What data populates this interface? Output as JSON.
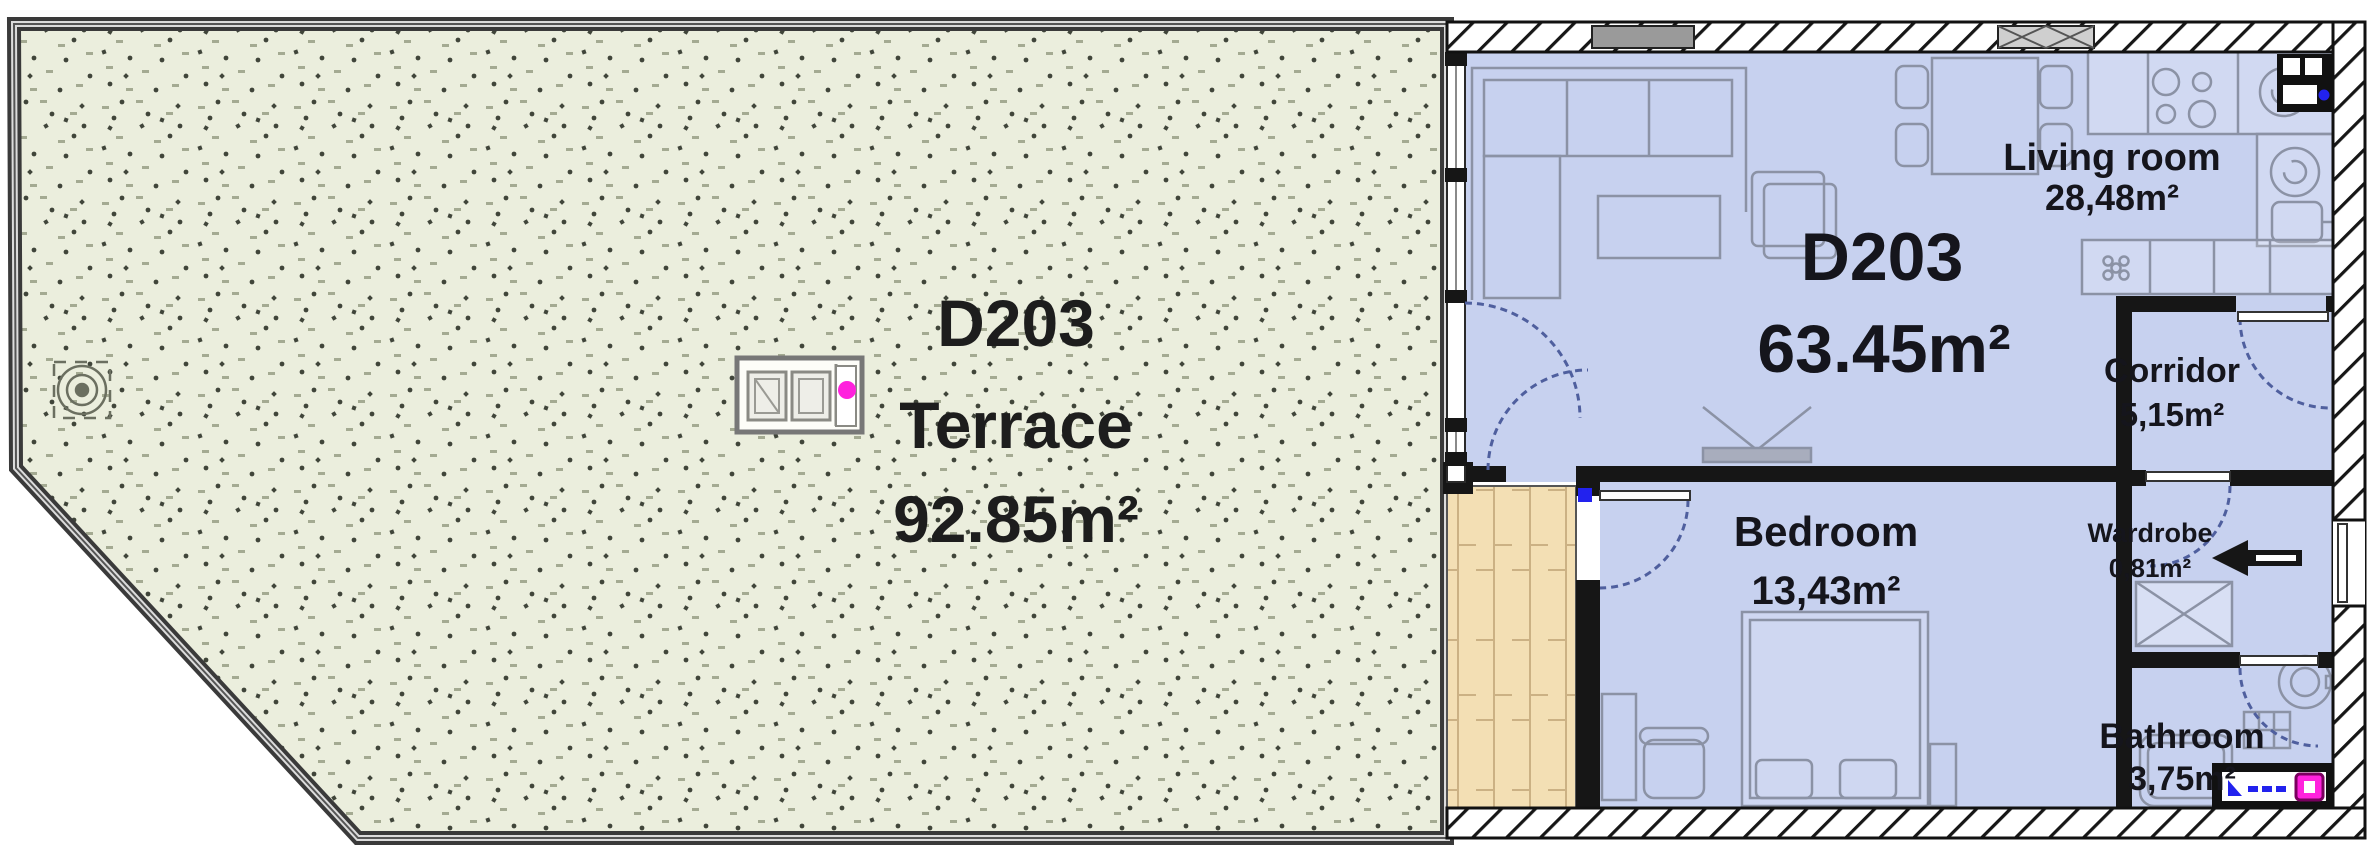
{
  "terrace": {
    "code": "D203",
    "name": "Terrace",
    "area": "92.85m²"
  },
  "apartment": {
    "code": "D203",
    "area": "63.45m²"
  },
  "rooms": {
    "living": {
      "name": "Living room",
      "area": "28,48m²"
    },
    "corridor": {
      "name": "Corridor",
      "area": "5,15m²"
    },
    "bedroom": {
      "name": "Bedroom",
      "area": "13,43m²"
    },
    "wardrobe": {
      "name": "Wardrobe",
      "area": "0,81m²"
    },
    "bathroom": {
      "name": "Bathroom",
      "area": "3,75m²"
    }
  },
  "icons": {
    "entrance_arrow": "◀"
  },
  "colors": {
    "terrace_floor": "#ebeedd",
    "apartment_floor": "#c7d1ef",
    "deck_floor": "#f3dfb4",
    "wall": "#161616",
    "furniture_outline": "#8b92a5",
    "door_arc": "#4f5f9e",
    "accent_magenta": "#ff22dd",
    "accent_blue": "#2222ee",
    "label": "#15151c"
  }
}
